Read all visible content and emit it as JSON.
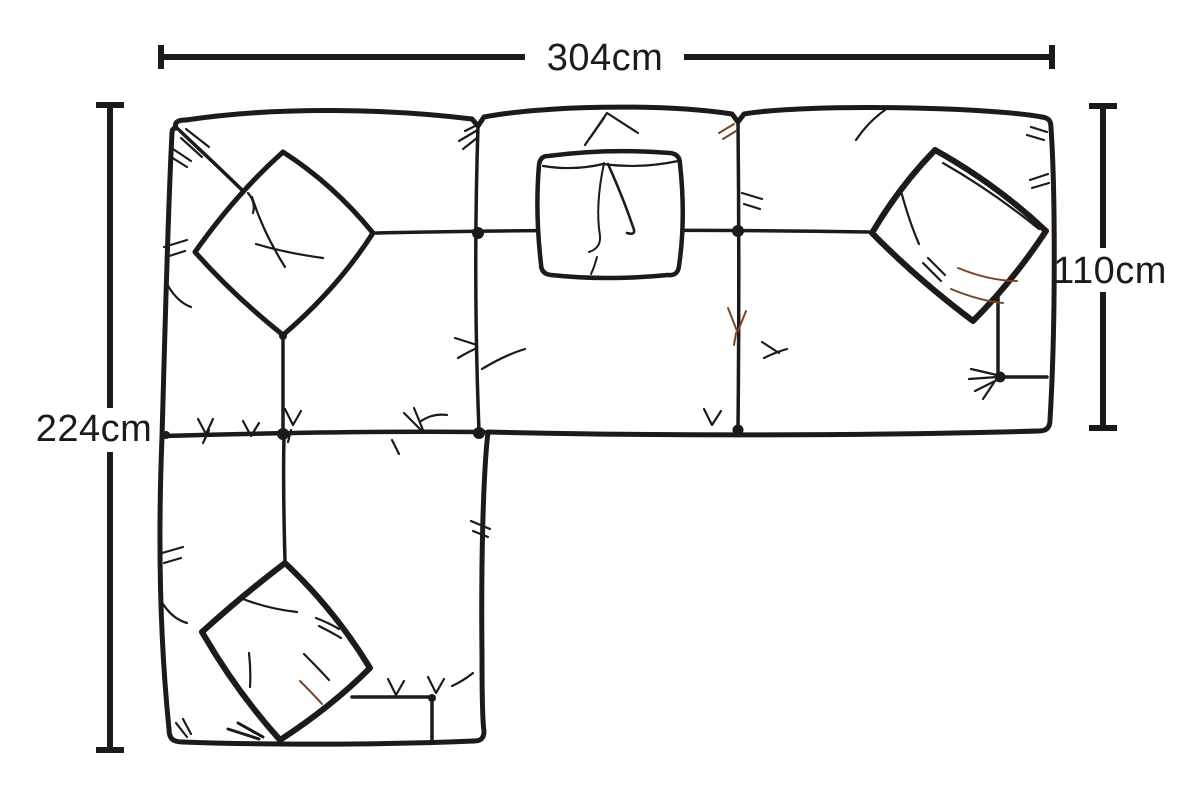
{
  "diagram": {
    "subject": "L-shaped sectional sofa with left chaise, top-down line drawing",
    "unit": "cm",
    "colors": {
      "ink": "#1e1a17",
      "sepia_accent": "#7a4526",
      "background": "#ffffff"
    },
    "dimensions": {
      "overall_width": {
        "label": "304cm",
        "value": 304,
        "orientation": "horizontal",
        "position": "top"
      },
      "overall_depth": {
        "label": "224cm",
        "value": 224,
        "orientation": "vertical",
        "position": "left"
      },
      "sofa_depth": {
        "label": "110cm",
        "value": 110,
        "orientation": "vertical",
        "position": "right"
      }
    },
    "sofa": {
      "sections": [
        "corner seat",
        "middle seat",
        "right seat",
        "chaise"
      ],
      "scatter_pillows": 4
    }
  }
}
